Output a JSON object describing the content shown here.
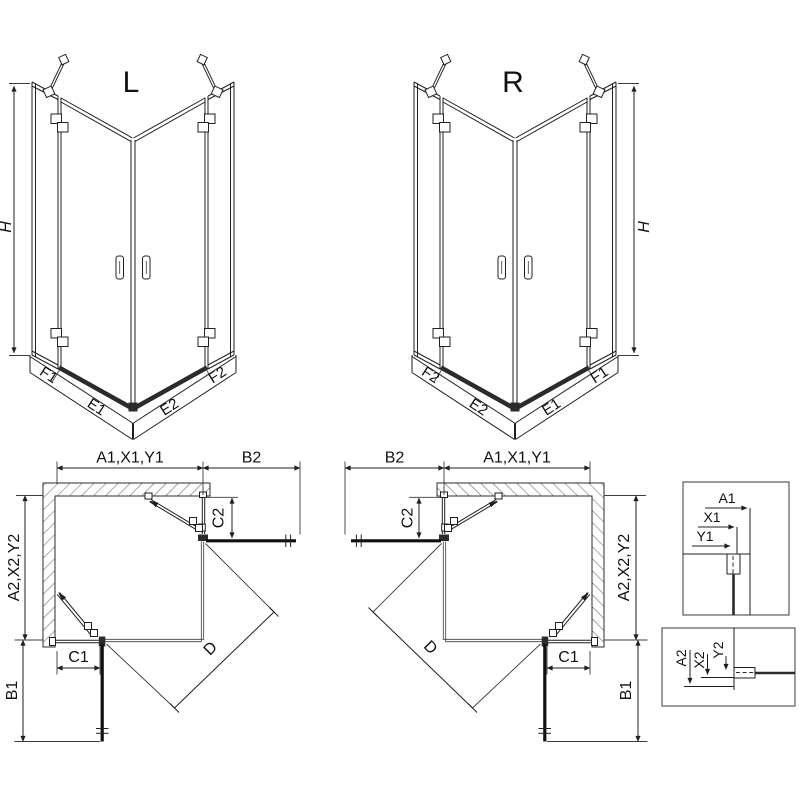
{
  "views": {
    "perspective_left": {
      "title": "L",
      "height_label": "H",
      "bottom_segments_left": [
        "F1",
        "E1"
      ],
      "bottom_segments_right": [
        "E2",
        "F2"
      ]
    },
    "perspective_right": {
      "title": "R",
      "height_label": "H",
      "bottom_segments_left": [
        "F2",
        "E2"
      ],
      "bottom_segments_right": [
        "E1",
        "F1"
      ]
    },
    "plan_left": {
      "a1_group": "A1,X1,Y1",
      "a2_group": "A2,X2,Y2",
      "b1": "B1",
      "b2": "B2",
      "c1": "C1",
      "c2": "C2",
      "d": "D"
    },
    "plan_right": {
      "a1_group": "A1,X1,Y1",
      "a2_group": "A2,X2,Y2",
      "b1": "B1",
      "b2": "B2",
      "c1": "C1",
      "c2": "C2",
      "d": "D"
    },
    "detail_top": {
      "a1": "A1",
      "x1": "X1",
      "y1": "Y1"
    },
    "detail_bottom": {
      "a2": "A2",
      "x2": "X2",
      "y2": "Y2"
    }
  },
  "colors": {
    "line": "#1f1f1f",
    "dark_fill": "#2b2b2b",
    "background": "#ffffff"
  }
}
